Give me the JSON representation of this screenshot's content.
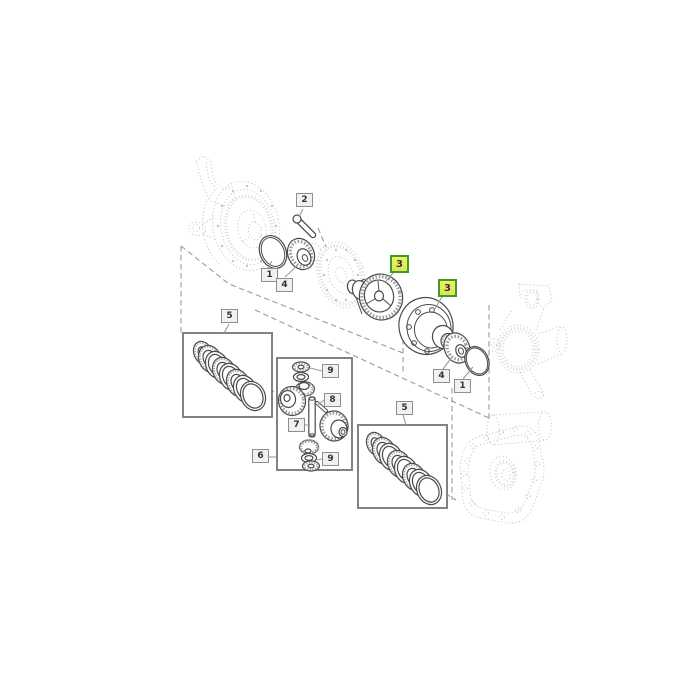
{
  "diagram": {
    "type": "exploded-parts-diagram",
    "subject": "differential assembly",
    "callouts": [
      {
        "id": "c2",
        "label": "2",
        "highlighted": false
      },
      {
        "id": "c1-left",
        "label": "1",
        "highlighted": false
      },
      {
        "id": "c4-left",
        "label": "4",
        "highlighted": false
      },
      {
        "id": "c3-a",
        "label": "3",
        "highlighted": true
      },
      {
        "id": "c3-b",
        "label": "3",
        "highlighted": true
      },
      {
        "id": "c5-left",
        "label": "5",
        "highlighted": false
      },
      {
        "id": "c9-top",
        "label": "9",
        "highlighted": false
      },
      {
        "id": "c8",
        "label": "8",
        "highlighted": false
      },
      {
        "id": "c7",
        "label": "7",
        "highlighted": false
      },
      {
        "id": "c6",
        "label": "6",
        "highlighted": false
      },
      {
        "id": "c9-bottom",
        "label": "9",
        "highlighted": false
      },
      {
        "id": "c4-right",
        "label": "4",
        "highlighted": false
      },
      {
        "id": "c1-right",
        "label": "1",
        "highlighted": false
      },
      {
        "id": "c5-right",
        "label": "5",
        "highlighted": false
      }
    ],
    "colors": {
      "background": "#ffffff",
      "solid_line": "#4a4a4a",
      "ghost_line": "#c9c9c9",
      "leader_line": "#9a9a9a",
      "box_border": "#828282",
      "callout_fill": "#f1f1f1",
      "callout_border": "#8f8f8f",
      "callout_text": "#333333",
      "highlight_fill_top": "#edf266",
      "highlight_fill_bottom": "#d9e84e",
      "highlight_border": "#44982d"
    }
  }
}
